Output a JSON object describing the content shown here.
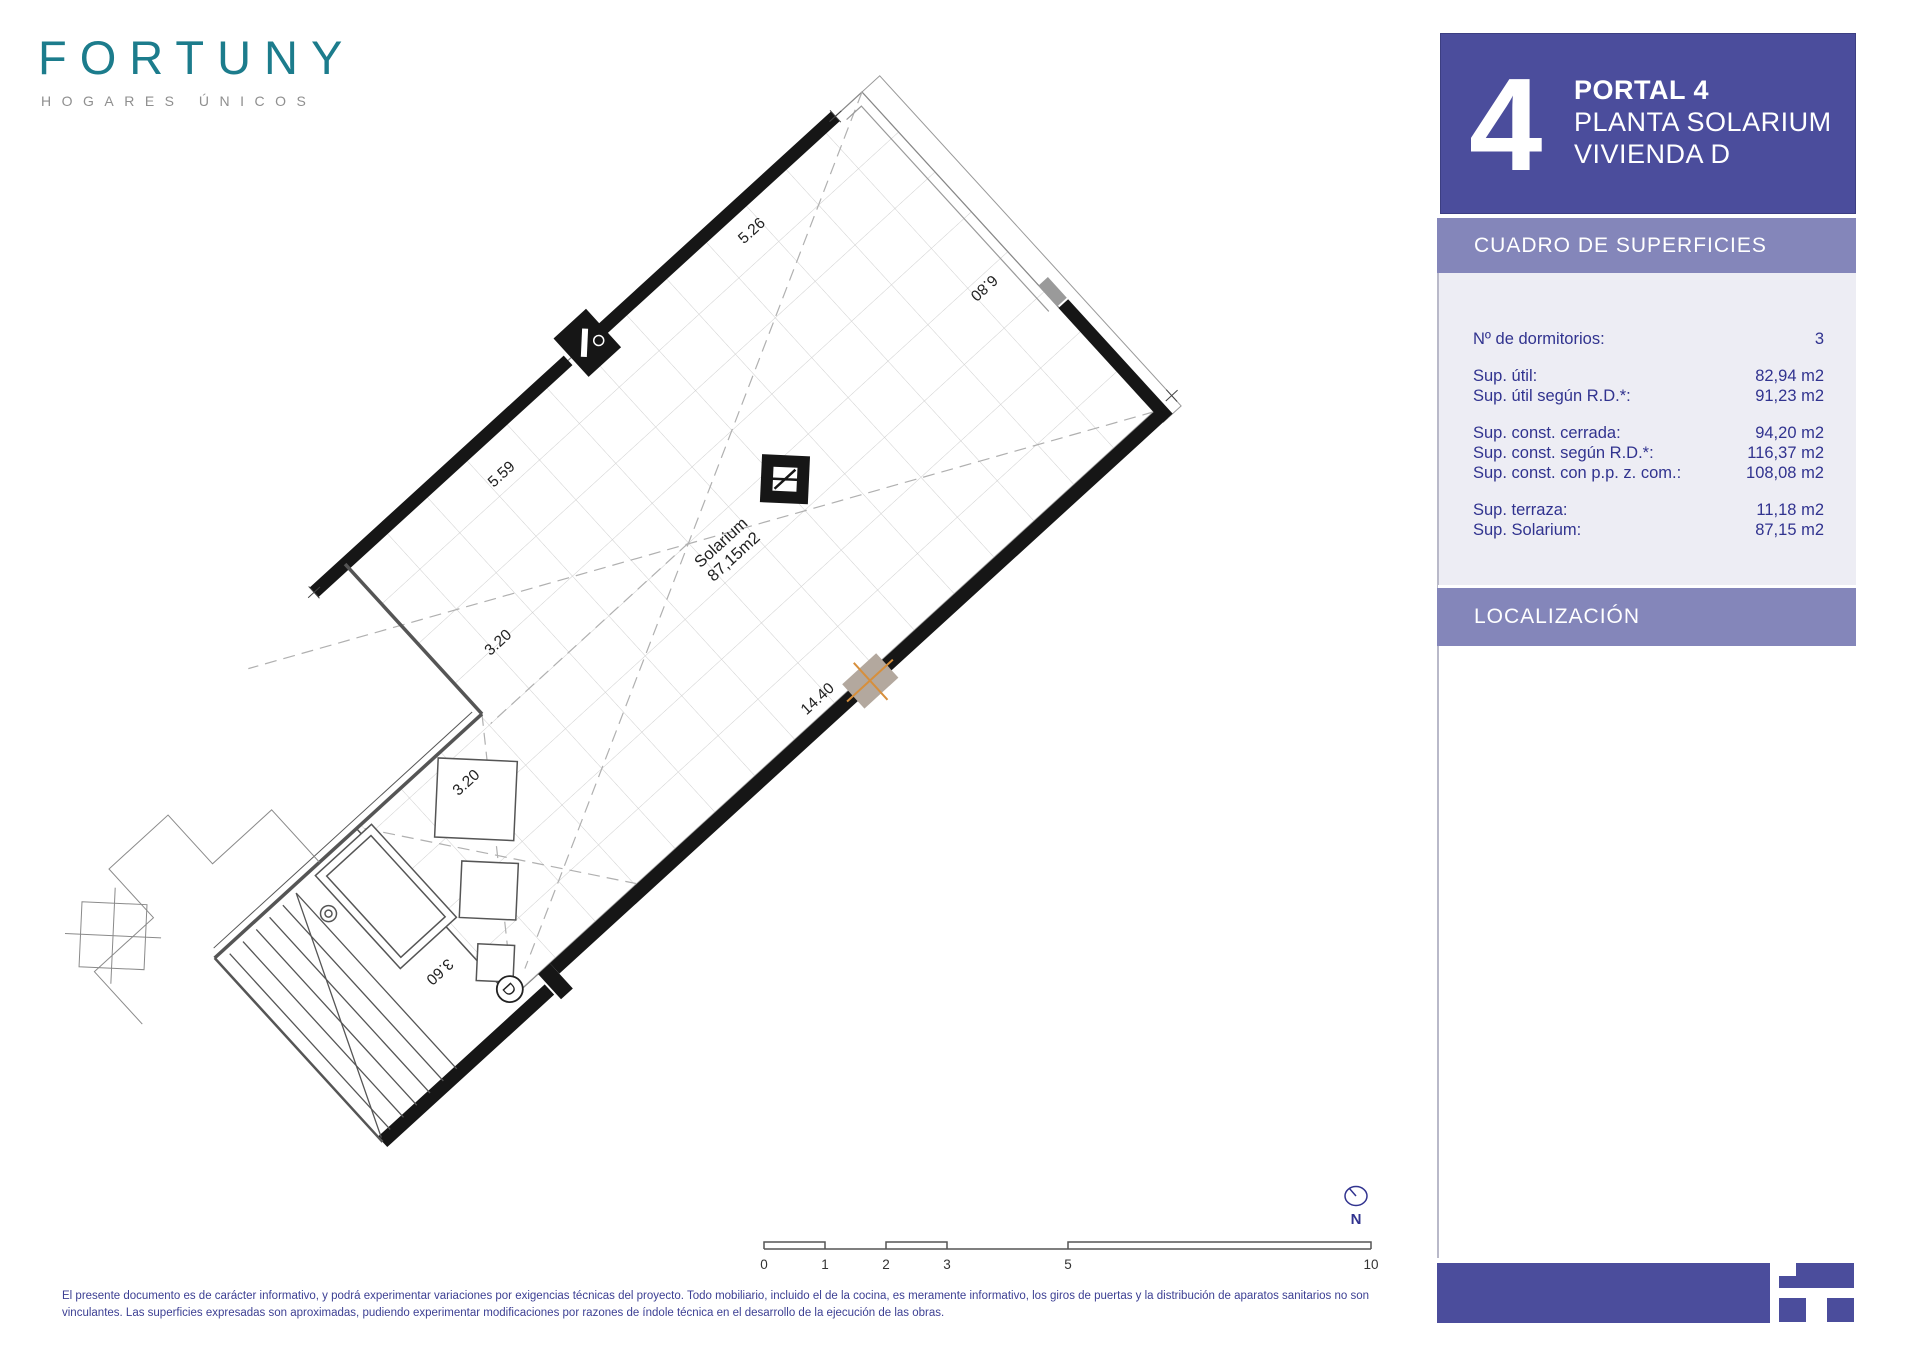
{
  "brand": {
    "name": "FORTUNY",
    "tagline": "HOGARES ÚNICOS"
  },
  "header": {
    "big_number": "4",
    "line1": "PORTAL 4",
    "line2": "PLANTA SOLARIUM",
    "line3": "VIVIENDA D"
  },
  "surfaces": {
    "title": "CUADRO DE SUPERFICIES",
    "rows": [
      {
        "label": "Nº de dormitorios:",
        "value": "3"
      },
      {
        "label": "Sup. útil:",
        "value": "82,94 m2"
      },
      {
        "label": "Sup. útil según R.D.*:",
        "value": "91,23 m2"
      },
      {
        "label": "Sup. const. cerrada:",
        "value": "94,20 m2"
      },
      {
        "label": "Sup. const. según R.D.*:",
        "value": "116,37 m2"
      },
      {
        "label": "Sup. const. con p.p. z. com.:",
        "value": "108,08 m2"
      },
      {
        "label": "Sup. terraza:",
        "value": "11,18 m2"
      },
      {
        "label": "Sup. Solarium:",
        "value": "87,15 m2"
      }
    ]
  },
  "localization": {
    "title": "LOCALIZACIÓN"
  },
  "plan": {
    "room": {
      "name": "Solarium",
      "area": "87,15m2"
    },
    "unit_letter": "D",
    "north_label": "N",
    "dimensions": {
      "top_left": "5.26",
      "top_right": "6.80",
      "left": "5.59",
      "inner_left": "3.20",
      "long_wall": "14.40",
      "notch": "3.20",
      "lower": "3.60"
    }
  },
  "scale_bar": {
    "ticks": [
      "0",
      "1",
      "2",
      "3",
      "5",
      "10"
    ]
  },
  "footer": {
    "disclaimer_line1": "El presente documento es de carácter informativo, y podrá experimentar variaciones por exigencias técnicas del proyecto. Todo mobiliario, incluido el de la cocina, es meramente informativo, los giros de puertas y la distribución de aparatos sanitarios no son",
    "disclaimer_line2": "vinculantes. Las superficies expresadas son aproximadas, pudiendo experimentar modificaciones por razones de índole técnica en el desarrollo de la ejecución de las obras."
  },
  "colors": {
    "indigo": "#4b4d9c",
    "band": "#8486ba",
    "panel_bg": "#ededf4",
    "navy_text": "#31338f",
    "brand_teal": "#1c7c8c",
    "highlight_teal": "#6fa0b4"
  }
}
